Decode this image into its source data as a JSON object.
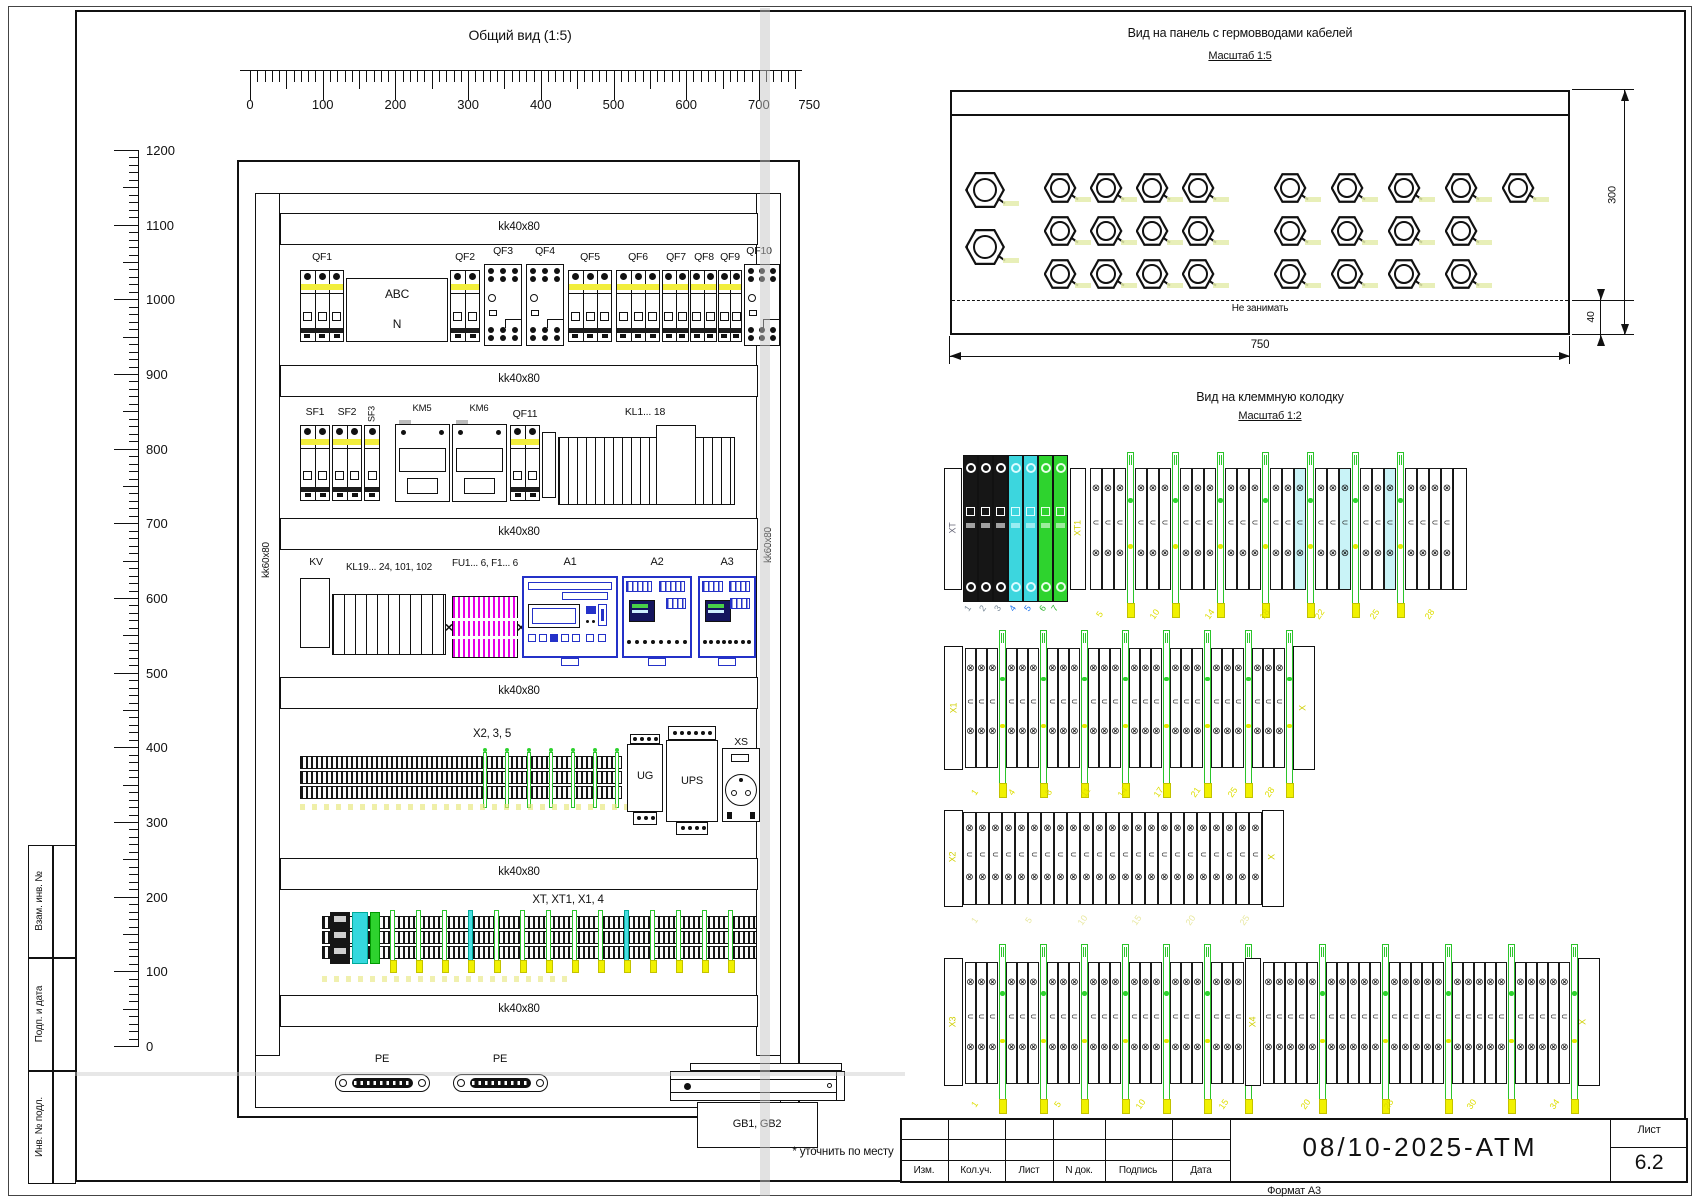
{
  "sheet": {
    "footnote": "* уточнить по месту",
    "stamp_labels": [
      "Взам. инв. №",
      "Подп. и дата",
      "Инв. № подл."
    ],
    "titleblock": {
      "columns": [
        "Изм.",
        "Кол.уч.",
        "Лист",
        "N док.",
        "Подпись",
        "Дата"
      ],
      "doc_number": "08/10-2025-АТМ",
      "sheet_word": "Лист",
      "sheet_number": "6.2",
      "format_note": "Формат А3"
    }
  },
  "general_view": {
    "title": "Общий вид (1:5)",
    "duct_label": "kk40x80",
    "vduct_label": "kk60x80",
    "h_ruler": [
      "0",
      "100",
      "200",
      "300",
      "400",
      "500",
      "600",
      "700",
      "750"
    ],
    "v_ruler": [
      "1200",
      "1100",
      "1000",
      "900",
      "800",
      "700",
      "600",
      "500",
      "400",
      "300",
      "200",
      "100",
      "0"
    ],
    "components": {
      "row1": [
        "QF1",
        "QF2",
        "QF3",
        "QF4",
        "QF5",
        "QF6",
        "QF7",
        "QF8",
        "QF9",
        "QF10"
      ],
      "abc_box": [
        "ABC",
        "N"
      ],
      "row2": [
        "SF1",
        "SF2",
        "SF3",
        "KM5",
        "KM6",
        "QF11",
        "KL1... 18"
      ],
      "row3": [
        "KV",
        "KL19... 24, 101, 102",
        "FU1... 6, F1... 6",
        "A1",
        "A2",
        "A3"
      ],
      "row4_label": "X2, 3, 5",
      "row4_units": [
        "UG",
        "UPS",
        "XS"
      ],
      "row5_label": "XT, XT1, X1, 4",
      "pe_label": "PE",
      "battery_label": "GB1, GB2"
    }
  },
  "gland_view": {
    "title": "Вид на панель с гермовводами кабелей",
    "scale": "Масштаб 1:5",
    "keep_clear": "Не занимать",
    "dims": {
      "width": "750",
      "height": "300",
      "margin": "40"
    },
    "glands": {
      "left_column": 2,
      "mid_grid_cols": 4,
      "mid_grid_rows": 3,
      "right_rows": [
        5,
        4,
        4
      ]
    }
  },
  "terminal_view": {
    "title": "Вид на клеммную колодку",
    "scale": "Масштаб 1:2",
    "rows": [
      {
        "labels": [
          "XT",
          "XT1"
        ],
        "numbers_gray": [
          "1",
          "2",
          "3"
        ],
        "numbers_blue": [
          "4",
          "5"
        ],
        "numbers_green": [
          "6",
          "7"
        ],
        "numbers_yellow": [
          "5",
          "10",
          "14",
          "18",
          "22",
          "25",
          "28"
        ]
      },
      {
        "labels": [
          "X1",
          "X"
        ],
        "numbers_yellow": [
          "1",
          "4",
          "8",
          "11",
          "14",
          "17",
          "21",
          "25",
          "28"
        ]
      },
      {
        "labels": [
          "X2",
          "X"
        ],
        "numbers_yellow": [
          "1",
          "5",
          "10",
          "15",
          "20",
          "25"
        ]
      },
      {
        "labels": [
          "X3",
          "X4",
          "X"
        ],
        "numbers_yellow": [
          "1",
          "5",
          "10",
          "15",
          "20",
          "25",
          "30",
          "34"
        ]
      }
    ]
  }
}
